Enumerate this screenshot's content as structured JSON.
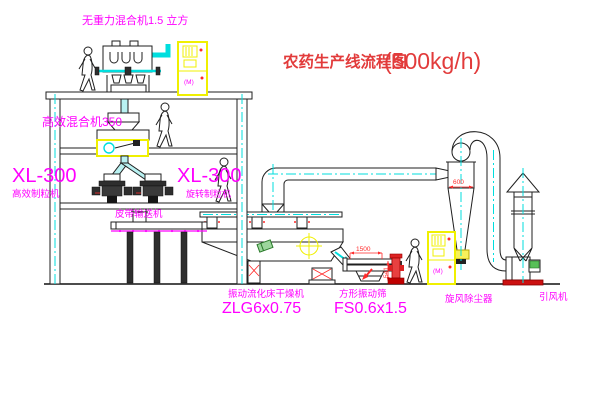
{
  "title": {
    "text": "农药生产线流程图",
    "capacity": "(500kg/h)"
  },
  "labels": {
    "top_mixer": "无重力混合机1.5 立方",
    "mixer_350": "高效混合机350",
    "xl300_left": "XL-300",
    "granulator_left": "高效制粒机",
    "xl300_right": "XL-300",
    "granulator_right": "旋转制粒机",
    "belt_conveyor": "皮带输送机",
    "dryer_name": "振动流化床干燥机",
    "dryer_model": "ZLG6x0.75",
    "sieve_name": "方形振动筛",
    "sieve_model": "FS0.6x1.5",
    "cyclone": "旋风除尘器",
    "fan": "引风机"
  },
  "dimensions": {
    "cyclone_inlet_width": "600",
    "sieve_length": "1500",
    "sieve_height": "541"
  },
  "cabinet_motor_symbol": "(M)",
  "colors": {
    "label_magenta": "#ff00ff",
    "title_red": "#e23b3b",
    "dimension_red": "#ff2a2a",
    "centerline_cyan": "#00dede",
    "highlight_yellow": "#f0f000",
    "background": "#ffffff"
  }
}
